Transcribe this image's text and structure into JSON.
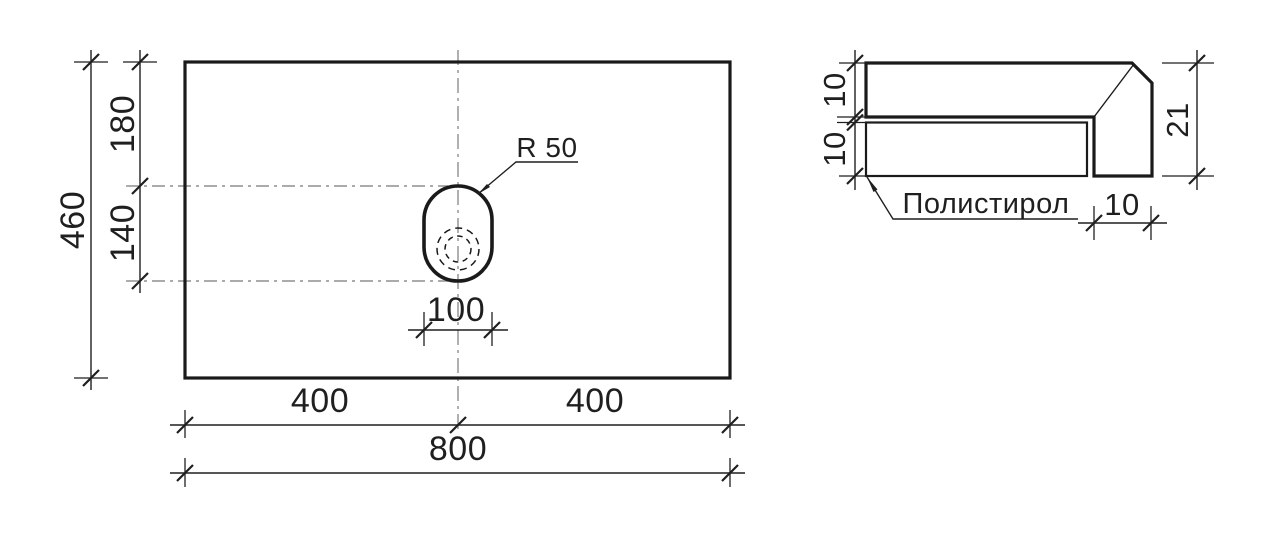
{
  "plan": {
    "dim_height_total": "460",
    "dim_top_offset": "180",
    "dim_hole_height": "140",
    "dim_hole_width": "100",
    "dim_half_left": "400",
    "dim_half_right": "400",
    "dim_width_total": "800",
    "radius_label": "R 50"
  },
  "section": {
    "dim_slab_thickness": "10",
    "dim_backing_thickness": "10",
    "dim_total_thickness": "21",
    "dim_edge_width": "10",
    "material_label": "Полистирол"
  },
  "colors": {
    "line": "#1a1a1a",
    "dim": "#1f1f1f",
    "centerline": "#8f8f8f",
    "hatch": "#b2b2b2",
    "hatch2": "#cecece",
    "bg": "#ffffff"
  }
}
